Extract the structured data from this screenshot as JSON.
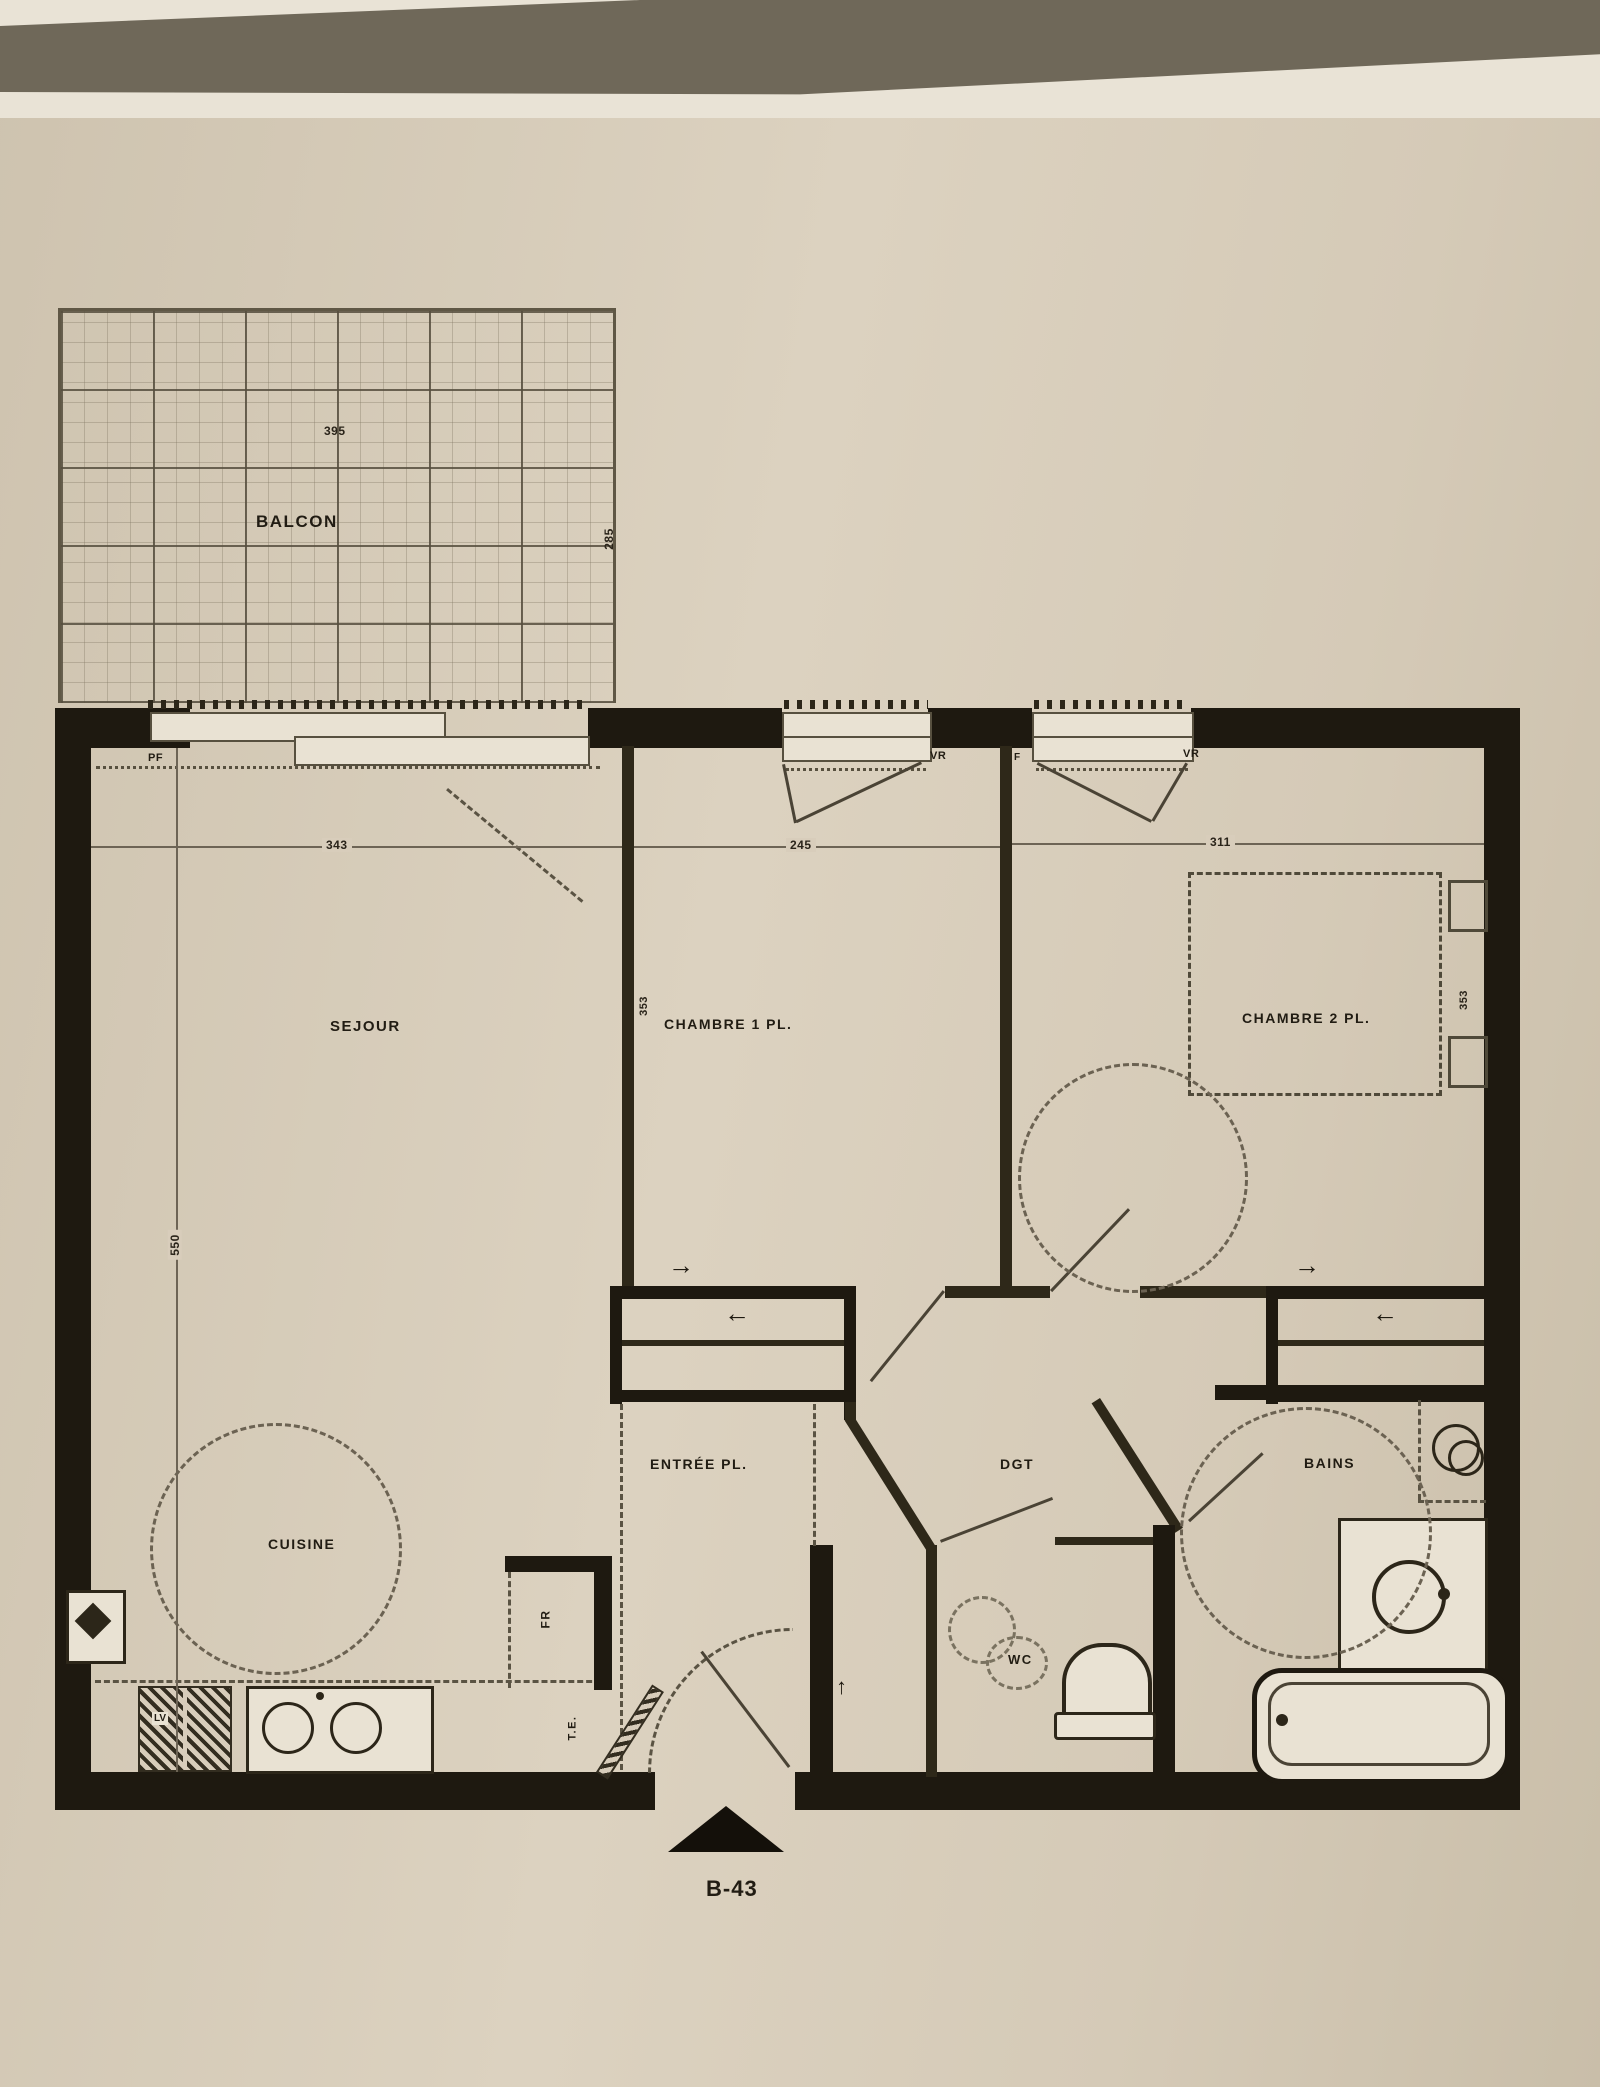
{
  "unit": {
    "label": "B-43"
  },
  "rooms": {
    "balcon": "BALCON",
    "sejour": "SEJOUR",
    "chambre1": "CHAMBRE 1 PL.",
    "chambre2": "CHAMBRE 2 PL.",
    "cuisine": "CUISINE",
    "entree": "ENTRÉE PL.",
    "degagement": "DGT",
    "wc": "WC",
    "bains": "BAINS"
  },
  "dimensions": {
    "balcon_width": "395",
    "balcon_depth": "285",
    "sejour_width": "343",
    "sejour_depth": "550",
    "chambre1_width": "245",
    "chambre1_depth": "353",
    "chambre2_width": "311",
    "chambre2_depth": "353"
  },
  "window_tags": {
    "pf": "PF",
    "vr_chambre1": "VR",
    "f_chambre2": "F",
    "vr_chambre2": "VR"
  },
  "equipment_tags": {
    "fridge": "FR",
    "electrical_panel": "T.E.",
    "dishwasher": "LV"
  },
  "icons": {
    "arrow_right": "→",
    "arrow_left": "←",
    "arrow_up": "↑"
  },
  "colors": {
    "paper": "#d8cdbb",
    "ink": "#211c13",
    "wall": "#1e1910",
    "backdrop": "#6f6859"
  }
}
